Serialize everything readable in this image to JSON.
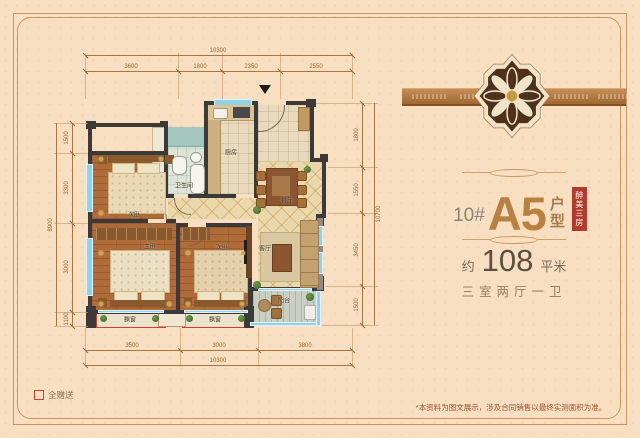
{
  "right_panel": {
    "building": "10#",
    "unit": "A5",
    "unit_suffix_1": "户",
    "unit_suffix_2": "型",
    "badge_vertical": "醉美三房",
    "area_prefix": "约",
    "area_value": "108",
    "area_unit": "平米",
    "layout_summary": "三室两厅一卫",
    "disclaimer": "*本资料为图文展示，涉及合同销售以最终实测面积为准。",
    "colors": {
      "accent_red": "#b23b2c",
      "title_brown": "#b8813f",
      "band_brown": "#9a6330"
    }
  },
  "legend": {
    "gift_label": "全赠送",
    "swatch_color": "#d04030"
  },
  "fp": {
    "rooms": {
      "bed2": "次卧",
      "bath": "卫生间",
      "kitchen": "厨房",
      "dining": "餐厅",
      "living": "客厅",
      "master": "主卧",
      "bed3": "次卧",
      "balcony": "阳台",
      "bay1": "飘窗",
      "bay2": "飘窗"
    },
    "dims": {
      "top_total": "10300",
      "top": [
        "3600",
        "1800",
        "2350",
        "2550"
      ],
      "bottom": [
        "3500",
        "3000",
        "3800"
      ],
      "bottom_total": "10300",
      "left": [
        "1500",
        "3300",
        "3000",
        "1100"
      ],
      "left_total": "8900",
      "right": [
        "1800",
        "1550",
        "3450",
        "1500"
      ],
      "right_total": "10700"
    }
  }
}
